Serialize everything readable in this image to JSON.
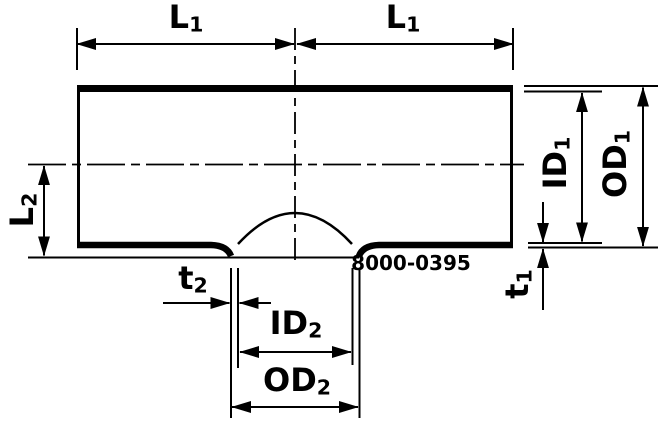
{
  "colors": {
    "ink": "#000000",
    "background": "#ffffff"
  },
  "figure_number": "8000-0395",
  "labels": {
    "l1_left": {
      "text": "L",
      "sub": "1"
    },
    "l1_right": {
      "text": "L",
      "sub": "1"
    },
    "l2": {
      "text": "L",
      "sub": "2"
    },
    "id1": {
      "text": "ID",
      "sub": "1"
    },
    "od1": {
      "text": "OD",
      "sub": "1"
    },
    "t1": {
      "text": "t",
      "sub": "1"
    },
    "t2": {
      "text": "t",
      "sub": "2"
    },
    "id2": {
      "text": "ID",
      "sub": "2"
    },
    "od2": {
      "text": "OD",
      "sub": "2"
    }
  }
}
